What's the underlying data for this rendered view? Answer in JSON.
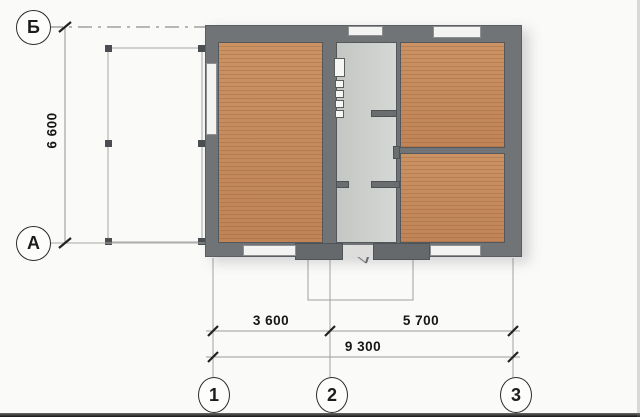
{
  "drawing": {
    "type": "architectural floor plan",
    "axis_labels": {
      "row_top": "Б",
      "row_bottom": "А",
      "col_1": "1",
      "col_2": "2",
      "col_3": "3"
    },
    "dimensions": {
      "vertical_total": "6 600",
      "bottom_segment_1": "3 600",
      "bottom_segment_2": "5 700",
      "bottom_total": "9 300"
    },
    "colors": {
      "paper": "#fafaf9",
      "wall": "#717477",
      "wood_floor": "#c68d5d",
      "hall_floor": "#cdd0cd",
      "window": "#f3f3f1",
      "line": "#9b9b99",
      "tick": "#222222"
    }
  }
}
